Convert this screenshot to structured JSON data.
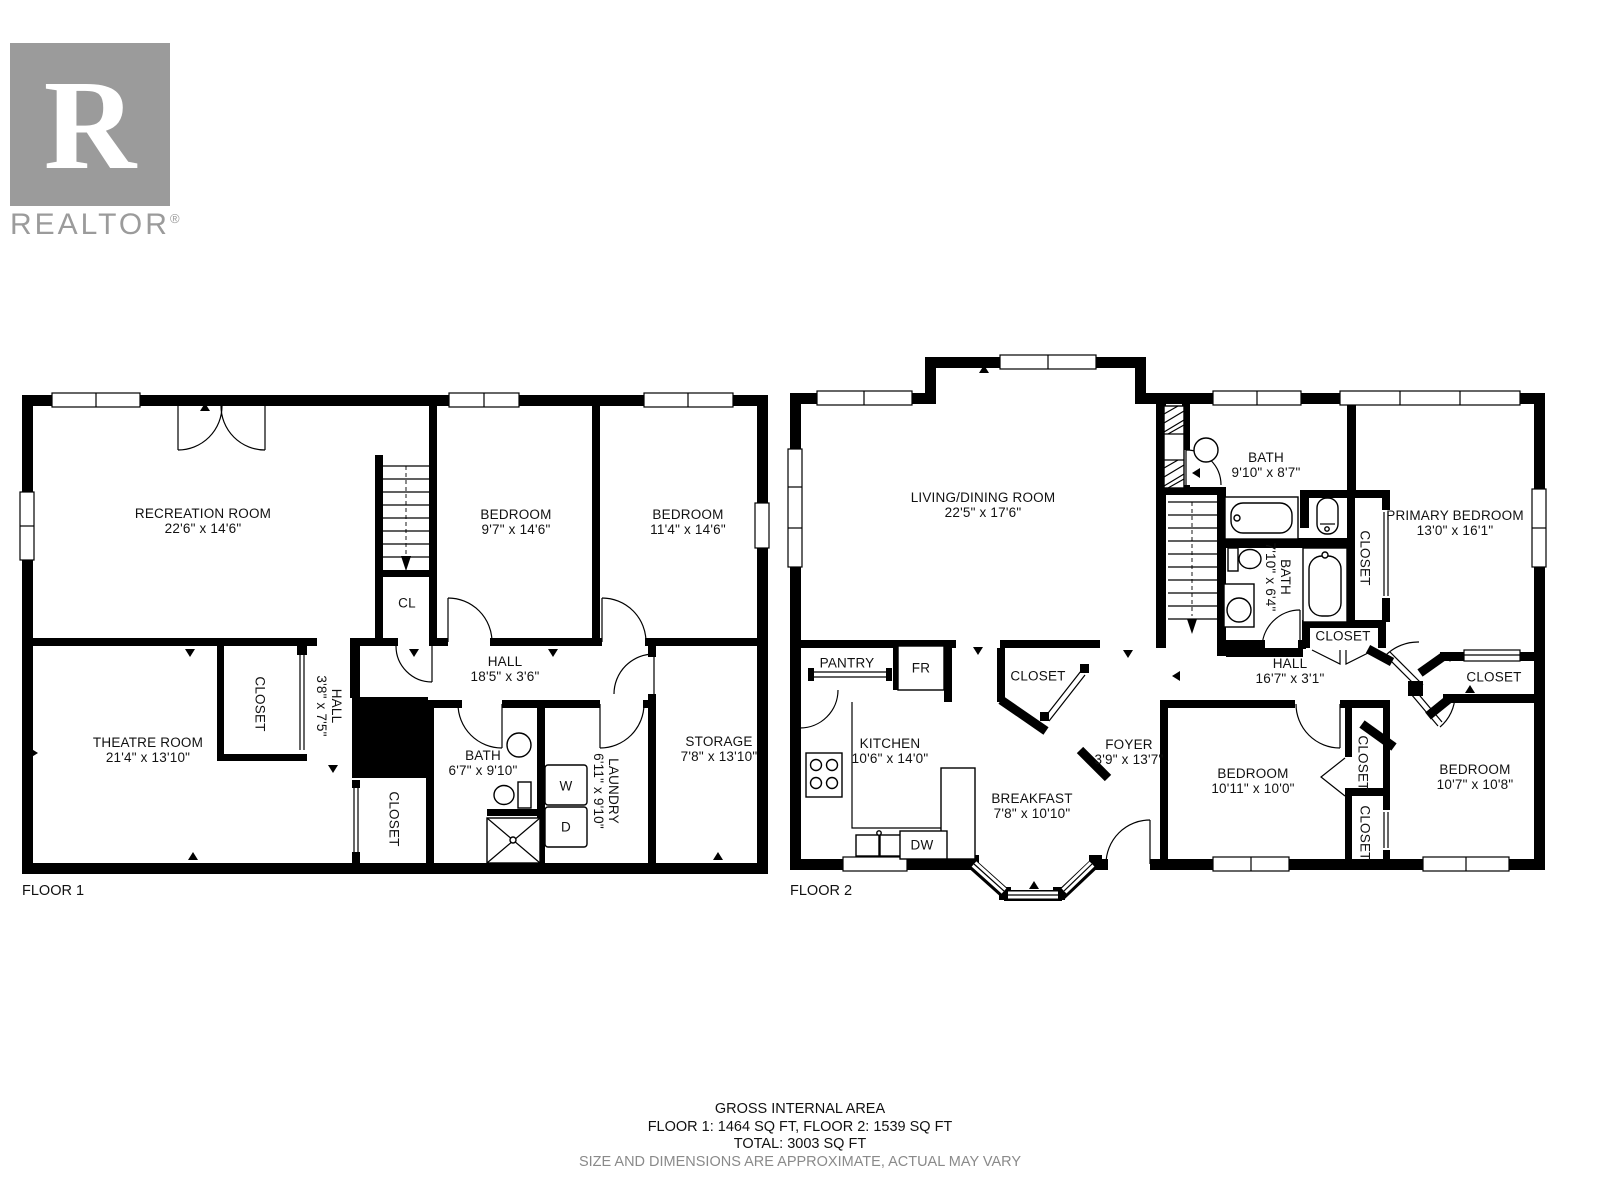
{
  "logo": {
    "letter": "R",
    "brand": "REALTOR",
    "registered": "®"
  },
  "floor1": {
    "label": "FLOOR 1",
    "rooms": {
      "recreation": {
        "name": "RECREATION ROOM",
        "dims": "22'6\" x 14'6\""
      },
      "bedroom_left": {
        "name": "BEDROOM",
        "dims": "9'7\" x 14'6\""
      },
      "bedroom_right": {
        "name": "BEDROOM",
        "dims": "11'4\" x 14'6\""
      },
      "cl": {
        "name": "CL"
      },
      "hall": {
        "name": "HALL",
        "dims": "18'5\" x 3'6\""
      },
      "theatre": {
        "name": "THEATRE ROOM",
        "dims": "21'4\" x 13'10\""
      },
      "closet_theatre": {
        "name": "CLOSET"
      },
      "hall_small": {
        "name": "HALL",
        "dims": "3'8\" x 7'5\""
      },
      "bath": {
        "name": "BATH",
        "dims": "6'7\" x 9'10\""
      },
      "closet_lower": {
        "name": "CLOSET"
      },
      "laundry": {
        "name": "LAUNDRY",
        "dims": "6'11\" x 9'10\""
      },
      "washer": "W",
      "dryer": "D",
      "storage": {
        "name": "STORAGE",
        "dims": "7'8\" x 13'10\""
      }
    }
  },
  "floor2": {
    "label": "FLOOR 2",
    "rooms": {
      "living_dining": {
        "name": "LIVING/DINING ROOM",
        "dims": "22'5\" x 17'6\""
      },
      "pantry": {
        "name": "PANTRY"
      },
      "fridge": "FR",
      "entry_closet": {
        "name": "CLOSET"
      },
      "kitchen": {
        "name": "KITCHEN",
        "dims": "10'6\" x 14'0\""
      },
      "breakfast": {
        "name": "BREAKFAST",
        "dims": "7'8\" x 10'10\""
      },
      "foyer": {
        "name": "FOYER",
        "dims": "3'9\" x 13'7\""
      },
      "dishwasher": "DW",
      "bath_upper": {
        "name": "BATH",
        "dims": "9'10\" x 8'7\""
      },
      "bath_lower": {
        "name": "BATH",
        "dims": "7'10\" x 6'4\""
      },
      "primary_bedroom": {
        "name": "PRIMARY BEDROOM",
        "dims": "13'0\" x 16'1\""
      },
      "closet_primary": {
        "name": "CLOSET"
      },
      "closet_hall": {
        "name": "CLOSET"
      },
      "hall": {
        "name": "HALL",
        "dims": "16'7\" x 3'1\""
      },
      "closet_right": {
        "name": "CLOSET"
      },
      "bedroom_left": {
        "name": "BEDROOM",
        "dims": "10'11\" x 10'0\""
      },
      "closet_mid_upper": {
        "name": "CLOSET"
      },
      "closet_mid_lower": {
        "name": "CLOSET"
      },
      "bedroom_right": {
        "name": "BEDROOM",
        "dims": "10'7\" x 10'8\""
      }
    }
  },
  "footer": {
    "title": "GROSS INTERNAL AREA",
    "floors": "FLOOR 1: 1464 SQ FT, FLOOR 2: 1539 SQ FT",
    "total": "TOTAL: 3003 SQ FT",
    "disclaimer": "SIZE AND DIMENSIONS ARE APPROXIMATE, ACTUAL MAY VARY"
  },
  "colors": {
    "wall": "#000000",
    "logo_gray": "#9b9b9b",
    "disclaimer_gray": "#8a8a8a"
  }
}
